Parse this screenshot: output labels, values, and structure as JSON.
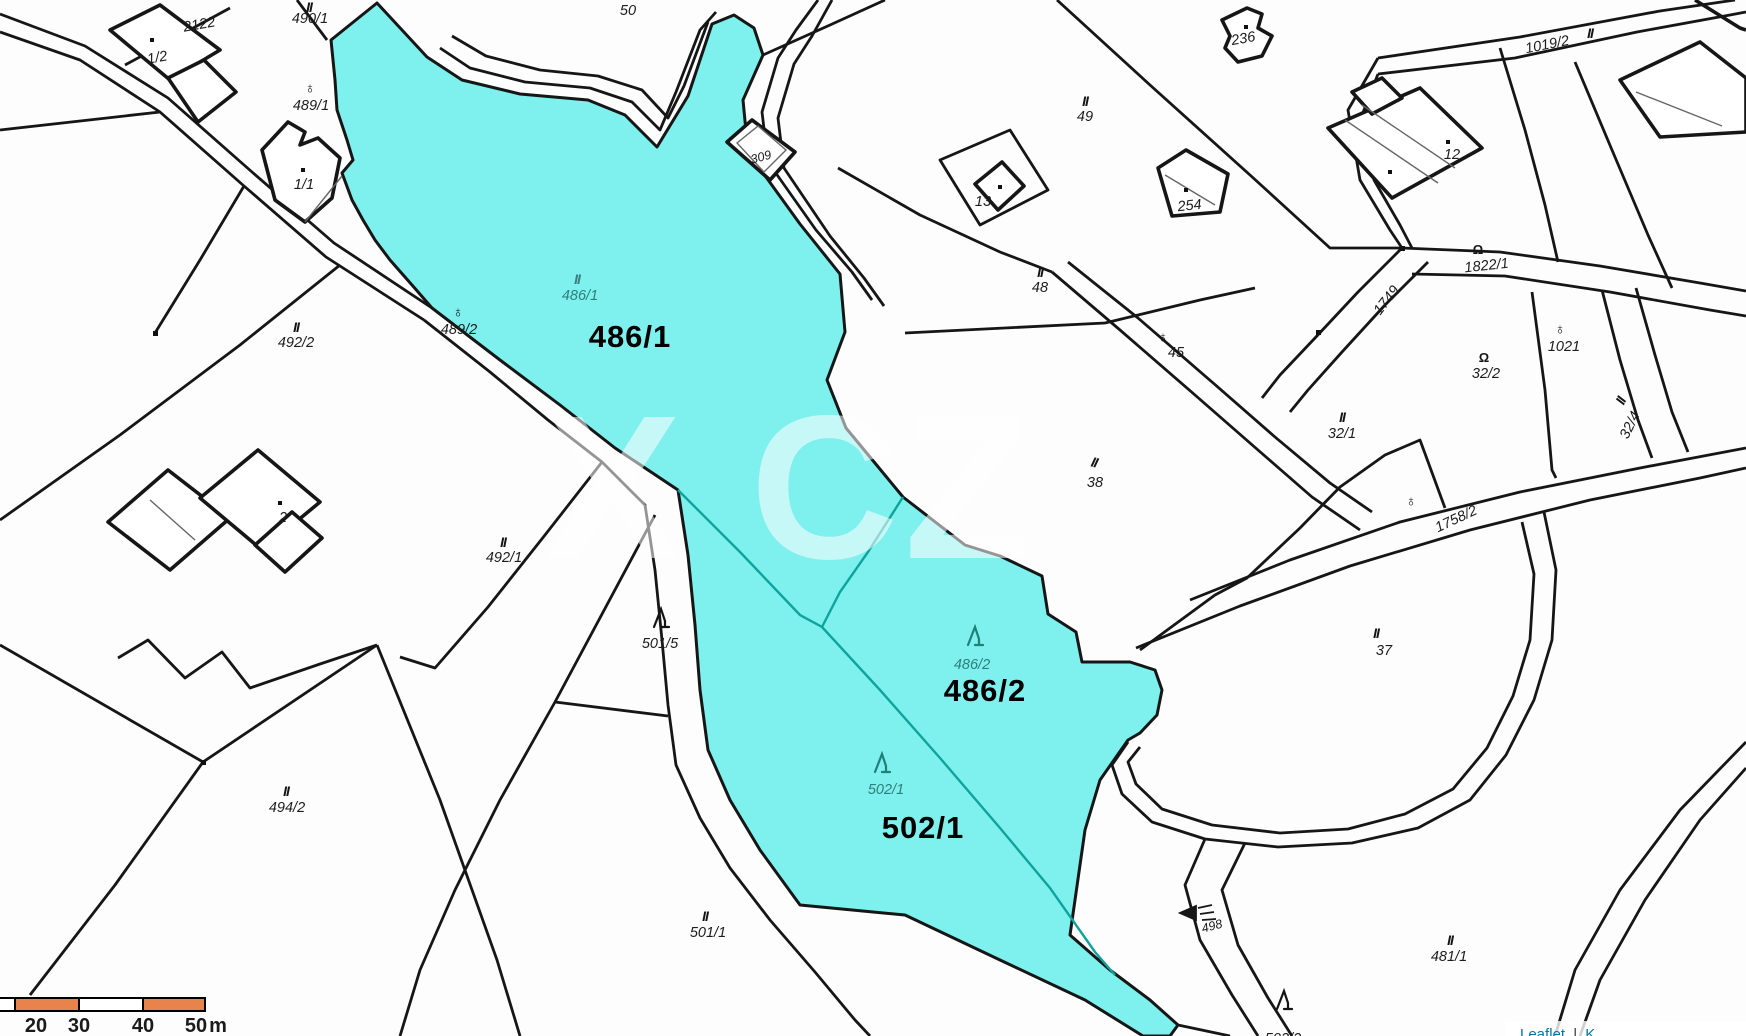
{
  "map": {
    "type": "cadastral-map",
    "highlighted_parcels": [
      "486/1",
      "486/2",
      "502/1"
    ],
    "colors": {
      "highlight_cyan": "#7EF0ED",
      "teal_boundary": "#0FA39D",
      "scale_orange": "#E8834C",
      "leaflet_blue": "#0078A8",
      "line_black": "#161616"
    }
  },
  "labels": {
    "p2122": "2122",
    "p1_2": "1/2",
    "p490_1": "490/1",
    "p50": "50",
    "p489_1": "489/1",
    "p1_1": "1/1",
    "p309": "309",
    "p13": "13",
    "p236": "236",
    "p254": "254",
    "p49": "49",
    "p12": "12",
    "p1019_2": "1019/2",
    "p492_2": "492/2",
    "p489_2": "489/2",
    "p486_1_small": "486/1",
    "p486_1_bold": "486/1",
    "p48": "48",
    "p45": "45",
    "p1749": "1749",
    "p1822_1": "1822/1",
    "p1021": "1021",
    "p32_2": "32/2",
    "p32_1": "32/1",
    "p32_4": "32/4",
    "p1758_2": "1758/2",
    "p38": "38",
    "p37": "37",
    "p2": "2",
    "p492_1": "492/1",
    "p501_5": "501/5",
    "p486_2_small": "486/2",
    "p486_2_bold": "486/2",
    "p502_1_small": "502/1",
    "p502_1_bold": "502/1",
    "p494_2": "494/2",
    "p501_1": "501/1",
    "p481_1": "481/1",
    "p498": "498",
    "p502_2": "502/2"
  },
  "symbols": {
    "ii": "II",
    "omega": "Ω",
    "earth": "♁"
  },
  "watermark": "X CZ",
  "scale_bar": {
    "t20": "20",
    "t30": "30",
    "t40": "40",
    "t50": "50",
    "unit": "m"
  },
  "attribution": {
    "leaflet": "Leaflet",
    "separator": "|",
    "tail": "K"
  }
}
